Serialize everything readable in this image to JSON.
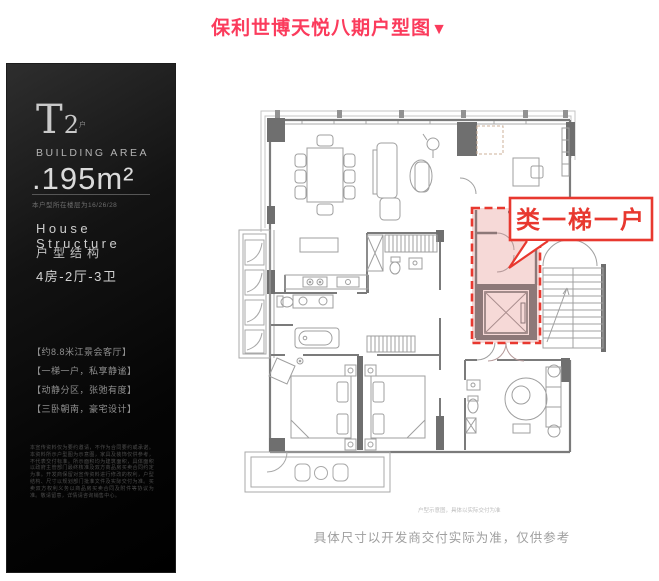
{
  "page": {
    "title": "保利世博天悦八期户型图",
    "title_marker": "▼",
    "footer_note": "具体尺寸以开发商交付实际为准，仅供参考"
  },
  "sidebar": {
    "unit_code": "T",
    "unit_number": "2",
    "unit_suffix": "户",
    "area_label": "BUILDING AREA",
    "area_value": ".195m²",
    "area_note": "本户型所在楼层为16/26/28",
    "structure_label_en": "House Structure",
    "structure_label_cn": "户型结构",
    "layout": "4房-2厅-3卫",
    "features": [
      "【约8.8米江景会客厅】",
      "【一梯一户，私享静谧】",
      "【动静分区，张弛有度】",
      "【三卧朝南，豪宅设计】"
    ],
    "disclaimer": "本宣传资料仅为要约邀请，不作为合同要约或承诺。本资料所示户型图为示意图，家具及装饰仅供参考，不代表交付标准。所示面积均为建筑面积，具体面积以政府主管部门最终核准及双方商品房买卖合同约定为准。开发商保留对宣传资料进行修改的权利，户型结构、尺寸以规划部门批准文件及实际交付为准。买卖双方权利义务以商品房买卖合同及附件等协议为准。敬请留意，详情请咨询销售中心。"
  },
  "plan": {
    "highlight_label": "类一梯一户",
    "inner_note": "户型示意图，具体以实际交付为准",
    "colors": {
      "title_red": "#fb3b5c",
      "highlight_border": "#e8382f",
      "highlight_fill": "#f6d9d7",
      "highlight_wall": "#8d7878",
      "wall_gray": "#6f6f6f",
      "line_gray": "#a9a9a9"
    }
  }
}
